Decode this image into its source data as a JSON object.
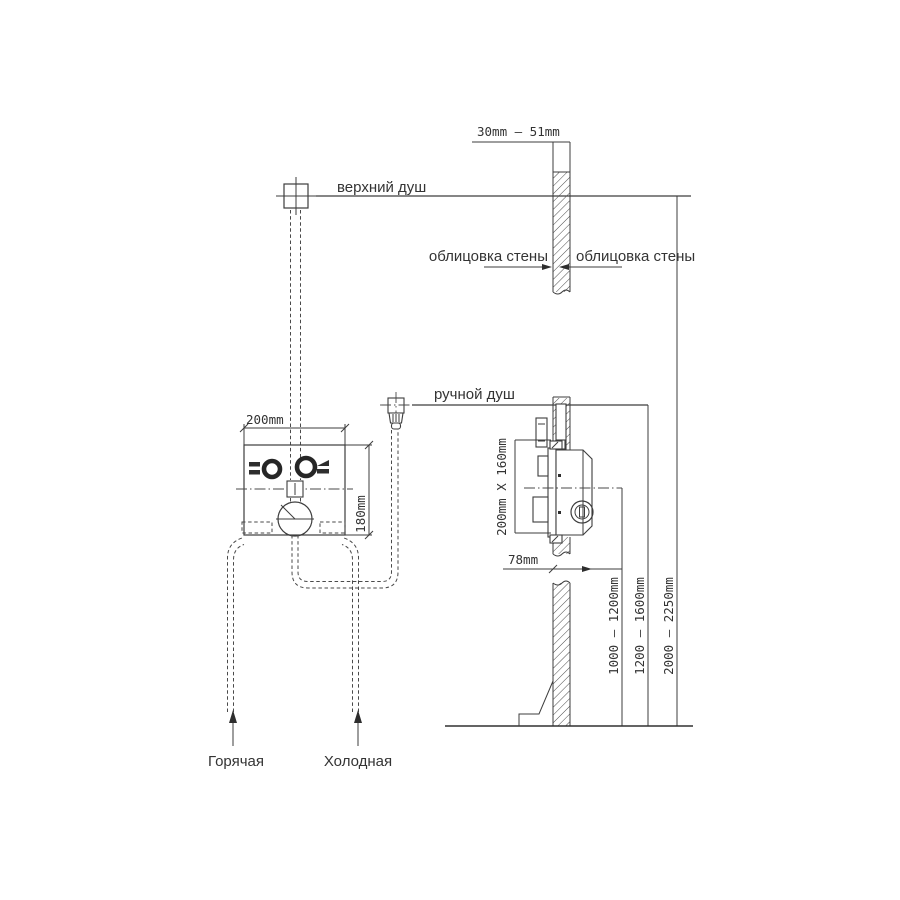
{
  "title": "Схема установки встраиваемого смесителя для душа",
  "labels": {
    "upper_shower": "верхний душ",
    "hand_shower": "ручной душ",
    "wall_cladding_left": "облицовка стены",
    "wall_cladding_right": "облицовка стены",
    "hot_supply": "Горячая",
    "cold_supply": "Холодная"
  },
  "dimensions": {
    "cladding_thickness_range": "30mm – 51mm",
    "mixer_width": "200mm",
    "mixer_height": "180mm",
    "box_face_size": "200mm X 160mm",
    "box_depth": "78mm",
    "mixer_height_range": "1000 – 1200mm",
    "hand_shower_height_range": "1200 – 1600mm",
    "upper_shower_height_range": "2000 – 2250mm"
  },
  "colors": {
    "line": "#3d3d3d",
    "text": "#333333",
    "background": "#ffffff"
  }
}
